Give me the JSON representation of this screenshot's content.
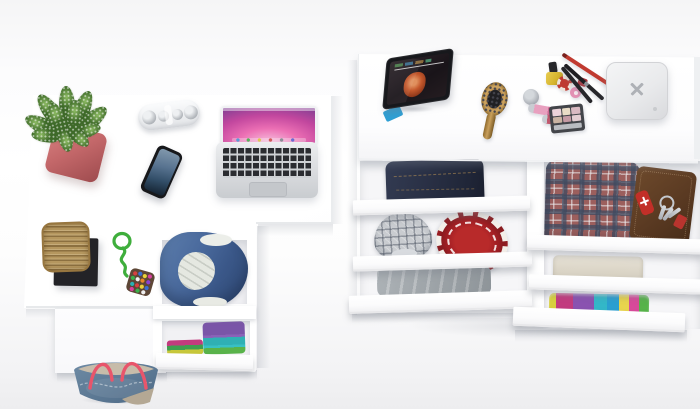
{
  "scene": {
    "type": "3d-product-render",
    "description": "Overhead studio view of a white home-office desk and a matching white dresser with open drawers, styled with electronics, a plant, cosmetics, accessories and folded clothes",
    "background": "seamless white studio backdrop"
  },
  "palette": {
    "pot-pink": "#c4686a",
    "leaf-green": "#5f9140",
    "speaker-white": "#f3f4f6",
    "phone-black": "#17181b",
    "laptop-silver": "#d9dbde",
    "key-black": "#2b2d31",
    "aurora-pink": "#ec6fb4",
    "basket-tan": "#b5975f",
    "tray-black": "#232327",
    "cord-green": "#3fae3c",
    "pouch-brown": "#5d4636",
    "denim-blue": "#4a6a9d",
    "lining-white": "#e5e8e1",
    "cloth-purple": "#7a55a8",
    "cloth-teal": "#2fb0b4",
    "cloth-magenta": "#c23b7e",
    "cloth-green": "#59b34a",
    "bag-denim": "#5e7a94",
    "bag-trim": "#c7bcaa",
    "strap-red": "#e8556b",
    "tablet-black": "#17181c",
    "stand-blue": "#2e9fd4",
    "hair-orange": "#c4582c",
    "wood-tan": "#b98d4e",
    "bristle-black": "#202023",
    "polish-yellow": "#d4b32c",
    "jar-silver": "#a9adb4",
    "gloss-pink": "#e8a0bf",
    "gloss-rose": "#c2586e",
    "pencil-red": "#c03a30",
    "case-grey": "#43454a",
    "box-grey": "#e9eaec",
    "logo-grey": "#aeb1b6",
    "jeans-indigo": "#2a3146",
    "cap-grey": "#c9ccd0",
    "hat-red": "#a31f24",
    "sweater-grey": "#9aa1a6",
    "tartan-base": "#9c5f5d",
    "wallet-brown": "#5a3a22",
    "knife-red": "#c22f28",
    "towel-beige": "#ddd7c9"
  },
  "objects": {
    "desk": {
      "label": "White L-shaped desk, top view"
    },
    "desk_front_panel": {
      "label": "Desk lower front panel"
    },
    "plant": {
      "label": "Green succulent in coral square pot"
    },
    "speaker": {
      "label": "White pill-shaped portable speaker"
    },
    "phone": {
      "label": "Black smartphone with blue lock screen"
    },
    "laptop": {
      "label": "Silver laptop with pink aurora wallpaper"
    },
    "basket": {
      "label": "Wicker basket on black stand"
    },
    "keychain": {
      "label": "Green cord keychain with multicolor beaded pouch"
    },
    "denim_cubby": {
      "label": "Open desk compartment with denim jacket and white lining"
    },
    "clothes_cubby": {
      "label": "Open desk compartment with folded purple, teal and green clothes"
    },
    "desk_drawer_front": {
      "label": "White desk drawer front"
    },
    "tote_bag": {
      "label": "Denim tote bag with red straps on the floor"
    },
    "dresser": {
      "label": "White dresser with open drawers"
    },
    "tablet": {
      "label": "Tablet on blue stand playing a movie with a red-haired character"
    },
    "hairbrush": {
      "label": "Wooden paddle hair brush"
    },
    "cosmetics": {
      "label": "Make-up set: yellow nail polish, silver jar, lip glosses, pencils, brush and eyeshadow palette"
    },
    "jewelry_box": {
      "label": "White jewelry box with X-shaped clasp"
    },
    "drawer_jeans": {
      "label": "Open drawer with folded dark denim jeans"
    },
    "drawer_cap": {
      "label": "Open drawer with grey plaid flat cap"
    },
    "drawer_red_hat": {
      "label": "Red hat with white pattern"
    },
    "drawer_sweater": {
      "label": "Open drawer with grey folded sweater"
    },
    "drawer_tartan": {
      "label": "Open drawer with red tartan shirt"
    },
    "wallet_keys": {
      "label": "Brown leather wallet with keys, red fob and red pocket knife"
    },
    "drawer_towel": {
      "label": "Open drawer with folded beige towel"
    },
    "drawer_tshirts": {
      "label": "Open drawer with colorful folded t-shirts"
    }
  }
}
